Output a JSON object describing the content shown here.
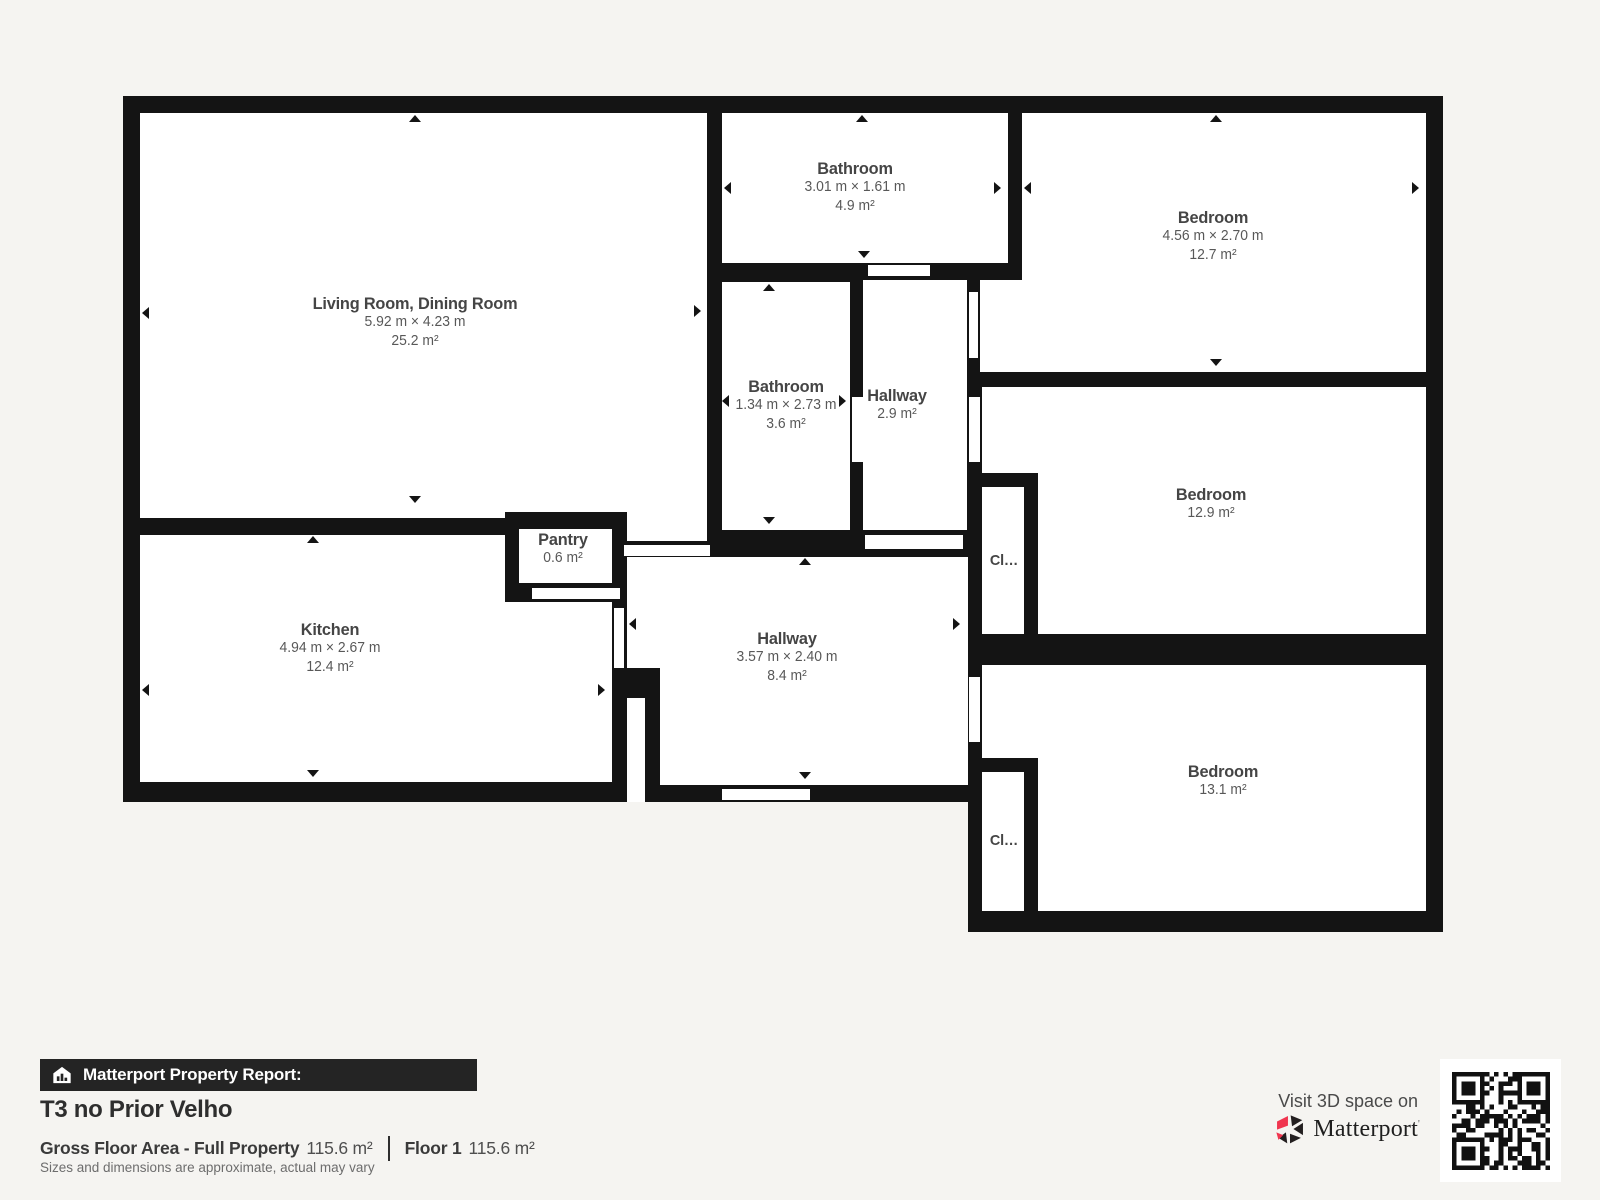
{
  "meta": {
    "report_label": "Matterport Property Report:",
    "title": "T3 no Prior Velho",
    "gross_floor_area_label": "Gross Floor Area - Full Property",
    "gross_floor_area_value": "115.6 m²",
    "floor_label": "Floor 1",
    "floor_area_value": "115.6 m²",
    "disclaimer": "Sizes and dimensions are approximate, actual may vary",
    "visit_text": "Visit 3D space on",
    "brand": "Matterport"
  },
  "rooms": {
    "living_room": {
      "name": "Living Room, Dining Room",
      "dimensions": "5.92 m × 4.23 m",
      "area": "25.2 m²"
    },
    "bathroom_top": {
      "name": "Bathroom",
      "dimensions": "3.01 m × 1.61 m",
      "area": "4.9 m²"
    },
    "bedroom_top": {
      "name": "Bedroom",
      "dimensions": "4.56 m × 2.70 m",
      "area": "12.7 m²"
    },
    "bathroom_middle": {
      "name": "Bathroom",
      "dimensions": "1.34 m × 2.73 m",
      "area": "3.6 m²"
    },
    "hallway_small": {
      "name": "Hallway",
      "area": "2.9 m²"
    },
    "bedroom_middle": {
      "name": "Bedroom",
      "area": "12.9 m²"
    },
    "kitchen": {
      "name": "Kitchen",
      "dimensions": "4.94 m × 2.67 m",
      "area": "12.4 m²"
    },
    "pantry": {
      "name": "Pantry",
      "area": "0.6 m²"
    },
    "hallway_main": {
      "name": "Hallway",
      "dimensions": "3.57 m × 2.40 m",
      "area": "8.4 m²"
    },
    "bedroom_bottom": {
      "name": "Bedroom",
      "area": "13.1 m²"
    },
    "closet_upper": {
      "name": "Cl…"
    },
    "closet_lower": {
      "name": "Cl…"
    }
  },
  "colors": {
    "wall": "#141414",
    "room": "#ffffff",
    "background": "#f5f4f1",
    "banner": "#242424",
    "brand_red": "#f0354f"
  }
}
